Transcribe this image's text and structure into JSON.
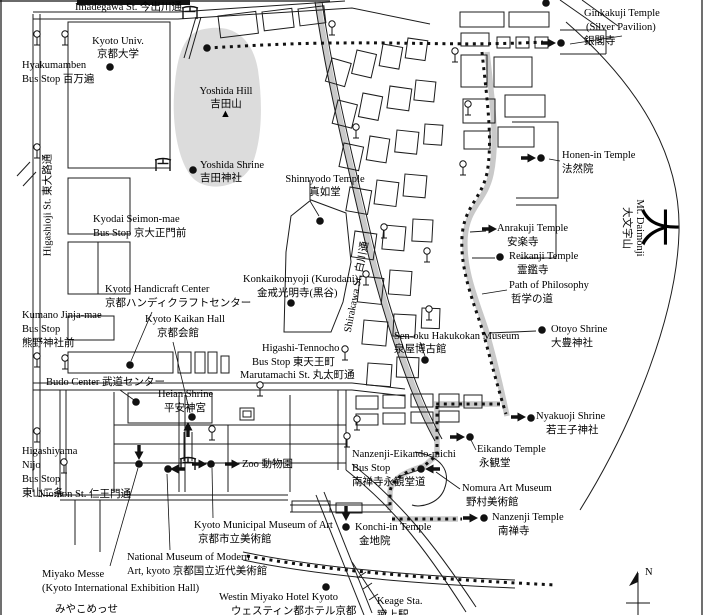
{
  "labels": {
    "imadegawa": {
      "l1": "Imadegawa St. 今出川通"
    },
    "kyoto_univ": {
      "l1": "Kyoto Univ.",
      "l2": "京都大学"
    },
    "hyakumamben": {
      "l1": "Hyakumamben",
      "l2": "Bus Stop 百万遍"
    },
    "yoshida_hill": {
      "l1": "Yoshida Hill",
      "l2": "吉田山"
    },
    "yoshida_shrine": {
      "l1": "Yoshida Shrine",
      "l2": "吉田神社"
    },
    "shinnyodo": {
      "l1": "Shinnyodo Temple",
      "l2": "真如堂"
    },
    "ginkakuji": {
      "l1": "Ginkakuji Temple",
      "l2": "(Silver Pavilion)",
      "l3": "銀閣寺"
    },
    "honen_in": {
      "l1": "Honen-in Temple",
      "l2": "法然院"
    },
    "kyodai_seimon": {
      "l1": "Kyodai Seimon-mae",
      "l2": "Bus Stop 京大正門前"
    },
    "higashioji": {
      "l1": "Higashioji St. 東大路通"
    },
    "mt_daimonji": {
      "l1": "Mt. Daimonji",
      "l2": "大文字山"
    },
    "big_dai": {
      "l1": "大"
    },
    "anrakuji": {
      "l1": "Anrakuji Temple",
      "l2": "安楽寺"
    },
    "reikanji": {
      "l1": "Reikanji Temple",
      "l2": "霊鑑寺"
    },
    "path_of_philosophy": {
      "l1": "Path of Philosophy",
      "l2": "哲学の道"
    },
    "konkaikomyoji": {
      "l1": "Konkaikomyoji (Kurodani)",
      "l2": "金戒光明寺(黒谷)"
    },
    "handicraft": {
      "l1": "Kyoto Handicraft Center",
      "l2": "京都ハンディクラフトセンター"
    },
    "kumano": {
      "l1": "Kumano Jinja-mae",
      "l2": "Bus Stop",
      "l3": "熊野神社前"
    },
    "kaikan": {
      "l1": "Kyoto Kaikan Hall",
      "l2": "京都会館"
    },
    "otoyo": {
      "l1": "Otoyo Shrine",
      "l2": "大豊神社"
    },
    "senoku": {
      "l1": "Sen-oku Hakukokan Museum",
      "l2": "泉屋博古館"
    },
    "shirakawa": {
      "l1": "Shirakawa St. 白川通"
    },
    "higashi_tennocho": {
      "l1": "Higashi-Tennocho",
      "l2": "Bus Stop 東天王町"
    },
    "marutamachi": {
      "l1": "Marutamachi St. 丸太町通"
    },
    "budo": {
      "l1": "Budo Center 武道センター"
    },
    "heian": {
      "l1": "Heian Shrine",
      "l2": "平安神宮"
    },
    "nyakuoji": {
      "l1": "Nyakuoji Shrine",
      "l2": "若王子神社"
    },
    "eikando": {
      "l1": "Eikando Temple",
      "l2": "永観堂"
    },
    "nanzenji_eikando_michi": {
      "l1": "Nanzenji-Eikando-michi",
      "l2": "Bus Stop",
      "l3": "南禅寺永観堂道"
    },
    "higashiyama_nijo": {
      "l1": "Higashiyama",
      "l2": "Nijo",
      "l3": "Bus Stop",
      "l4": "東山二条"
    },
    "niomon": {
      "l1": "Niomon St. 仁王門通"
    },
    "zoo": {
      "l1": "Zoo 動物園"
    },
    "nomura": {
      "l1": "Nomura Art Museum",
      "l2": "野村美術館"
    },
    "municipal_museum": {
      "l1": "Kyoto Municipal Museum of Art",
      "l2": "京都市立美術館"
    },
    "nanzenji": {
      "l1": "Nanzenji Temple",
      "l2": "南禅寺"
    },
    "konchi_in": {
      "l1": "Konchi-in Temple",
      "l2": "金地院"
    },
    "modern_art": {
      "l1": "National Museum of Modern",
      "l2": "Art, kyoto 京都国立近代美術館"
    },
    "miyako_messe": {
      "l1": "Miyako Messe",
      "l2": "(Kyoto International Exhibition Hall)",
      "l3": "みやこめっせ"
    },
    "westin": {
      "l1": "Westin Miyako Hotel Kyoto",
      "l2": "ウェスティン都ホテル京都"
    },
    "keage": {
      "l1": "Keage Sta.",
      "l2": "蹴上駅"
    },
    "compass": {
      "n": "N"
    },
    "peak": {
      "glyph": "▲"
    }
  },
  "colors": {
    "ink": "#000000",
    "hill_shade": "#dcdcdc",
    "road_shade": "#c9c9c9",
    "background": "#ffffff"
  }
}
